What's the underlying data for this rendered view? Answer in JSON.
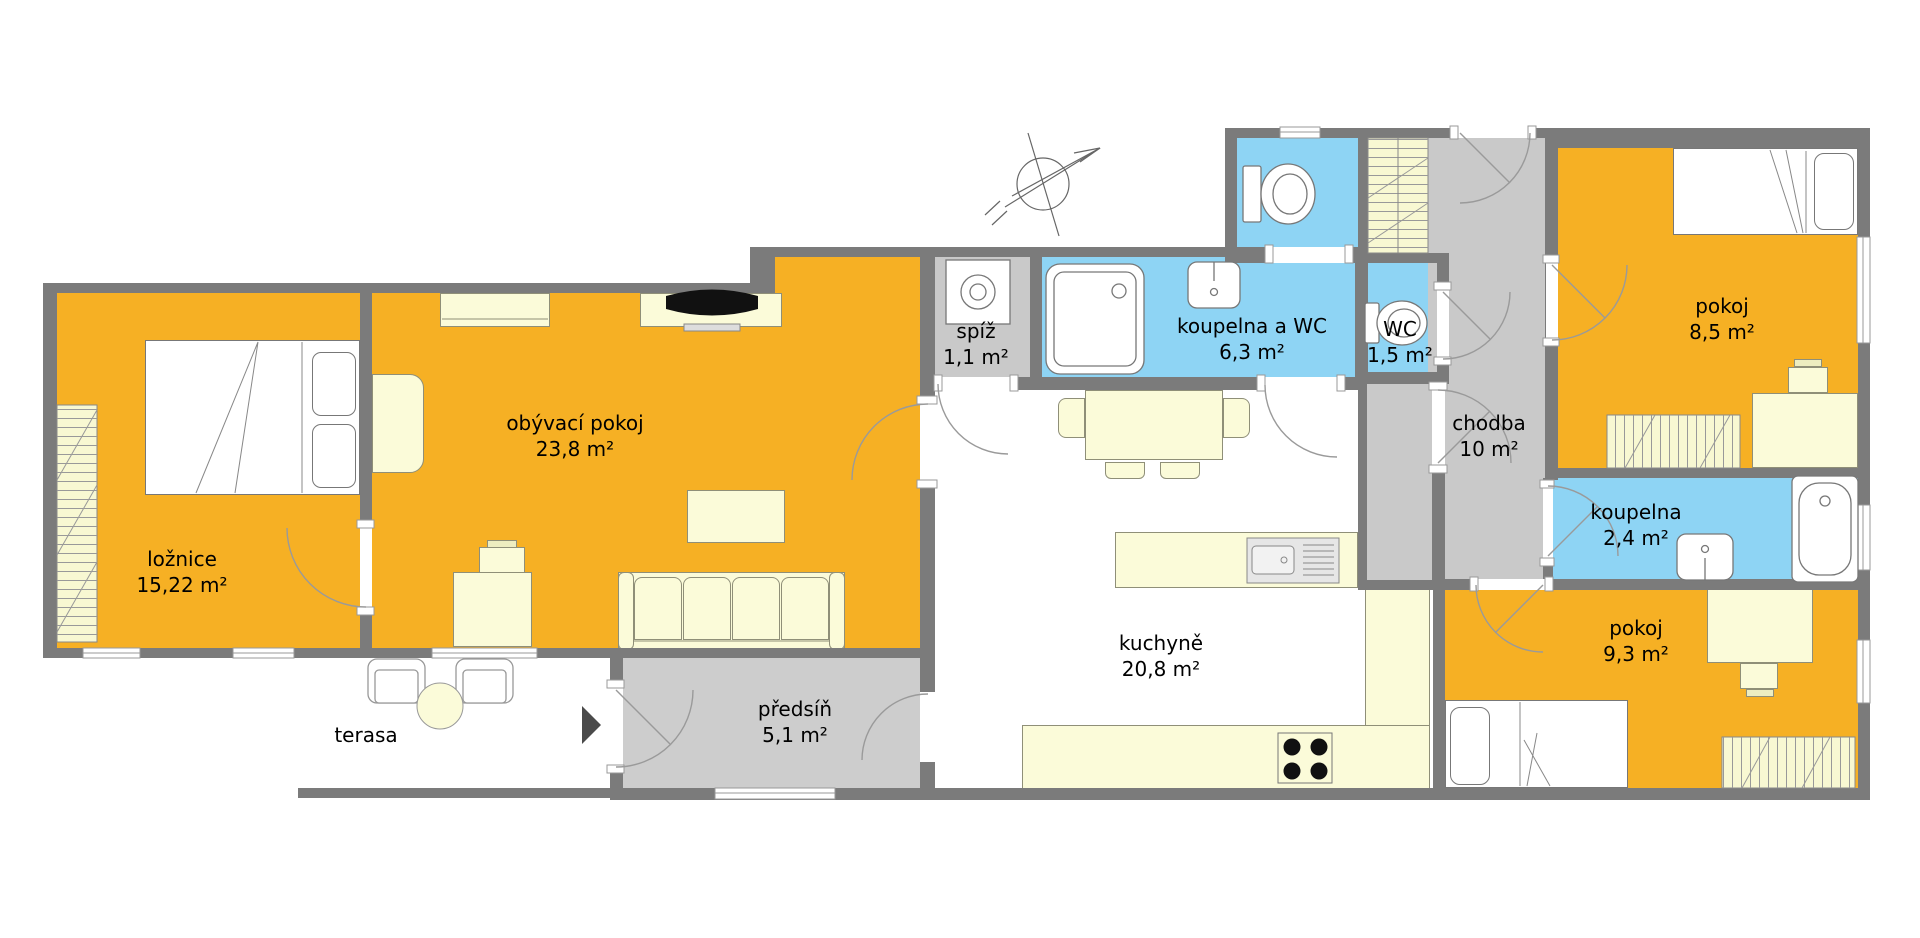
{
  "plan": {
    "type": "apartment-floor-plan",
    "rooms": [
      {
        "name": "ložnice",
        "area": "15,22 m²",
        "type": "bedroom",
        "color": "#F6B024"
      },
      {
        "name": "obývací pokoj",
        "area": "23,8 m²",
        "type": "living-room",
        "color": "#F6B024"
      },
      {
        "name": "spíž",
        "area": "1,1 m²",
        "type": "pantry",
        "color": "#C9C9C9"
      },
      {
        "name": "koupelna a WC",
        "area": "6,3 m²",
        "type": "bathroom-wc",
        "color": "#8ED4F4"
      },
      {
        "name": "WC",
        "area": "1,5 m²",
        "type": "wc",
        "color": "#8ED4F4"
      },
      {
        "name": "chodba",
        "area": "10 m²",
        "type": "hallway",
        "color": "#C9C9C9"
      },
      {
        "name": "pokoj",
        "area": "8,5 m²",
        "type": "room",
        "color": "#F6B024"
      },
      {
        "name": "koupelna",
        "area": "2,4 m²",
        "type": "bathroom",
        "color": "#8ED4F4"
      },
      {
        "name": "kuchyně",
        "area": "20,8 m²",
        "type": "kitchen",
        "color": "#FFFFFF"
      },
      {
        "name": "pokoj",
        "area": "9,3 m²",
        "type": "room",
        "color": "#F6B024"
      },
      {
        "name": "předsíň",
        "area": "5,1 m²",
        "type": "entrance-hall",
        "color": "#CDCDCD"
      },
      {
        "name": "terasa",
        "area": "",
        "type": "terrace",
        "color": "#FFFFFF"
      }
    ],
    "colors": {
      "wall": "#7B7B7B",
      "room_orange": "#F6B024",
      "room_blue": "#8ED4F4",
      "room_gray": "#C9C9C9",
      "furniture": "#FBFBD9",
      "outline": "#999999"
    }
  }
}
